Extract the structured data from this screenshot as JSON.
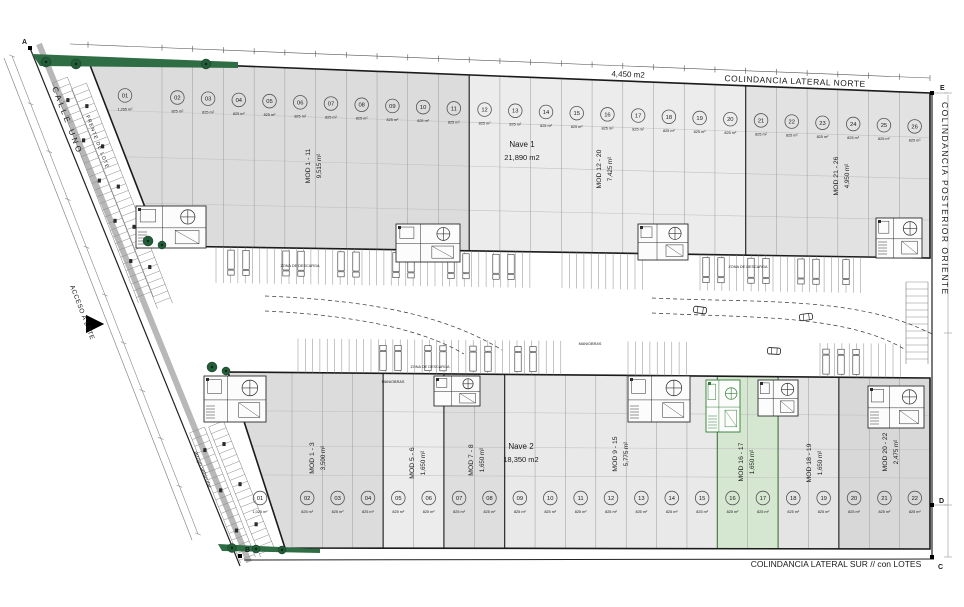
{
  "plan": {
    "streets": {
      "calle_uno": "CALLE UNO",
      "frente_de_lote": "FRENTE DE LOTE",
      "acceso_a_lote": "ACCESO A LOTE",
      "arroyo_vehicular": "arroyo vehicular"
    },
    "boundaries": {
      "north": "COLINDANCIA LATERAL NORTE",
      "east": "COLINDANCIA POSTERIOR ORIENTE",
      "south": "COLINDANCIA LATERAL SUR // con LOTES"
    },
    "corner_points": [
      "A",
      "B",
      "C",
      "D",
      "E"
    ],
    "top_area_label": "4,450 m2",
    "zone_labels": {
      "descarga": "ZONA DE DESCARGA",
      "maniobras": "MANIOBRAS"
    },
    "colors": {
      "highlight_green": "#d5e7d1",
      "tree_green": "#2f6e45",
      "module_gray_dark": "#dcdcdc",
      "module_gray_light": "#ececec"
    },
    "nave1": {
      "name": "Nave 1",
      "area": "21,890 m2",
      "groups": [
        {
          "label": "MOD 1 - 11",
          "area": "9,515 m²"
        },
        {
          "label": "MOD 12 - 20",
          "area": "7,425 m²"
        },
        {
          "label": "MOD 21 - 26",
          "area": "4,950 m²"
        }
      ],
      "modules": [
        {
          "num": "01",
          "area": "1,265 m²"
        },
        {
          "num": "02",
          "area": "825 m²"
        },
        {
          "num": "03",
          "area": "825 m²"
        },
        {
          "num": "04",
          "area": "825 m²"
        },
        {
          "num": "05",
          "area": "825 m²"
        },
        {
          "num": "06",
          "area": "825 m²"
        },
        {
          "num": "07",
          "area": "825 m²"
        },
        {
          "num": "08",
          "area": "825 m²"
        },
        {
          "num": "09",
          "area": "825 m²"
        },
        {
          "num": "10",
          "area": "825 m²"
        },
        {
          "num": "11",
          "area": "825 m²"
        },
        {
          "num": "12",
          "area": "825 m²"
        },
        {
          "num": "13",
          "area": "825 m²"
        },
        {
          "num": "14",
          "area": "825 m²"
        },
        {
          "num": "15",
          "area": "825 m²"
        },
        {
          "num": "16",
          "area": "825 m²"
        },
        {
          "num": "17",
          "area": "825 m²"
        },
        {
          "num": "18",
          "area": "825 m²"
        },
        {
          "num": "19",
          "area": "825 m²"
        },
        {
          "num": "20",
          "area": "825 m²"
        },
        {
          "num": "21",
          "area": "825 m²"
        },
        {
          "num": "22",
          "area": "825 m²"
        },
        {
          "num": "23",
          "area": "825 m²"
        },
        {
          "num": "24",
          "area": "825 m²"
        },
        {
          "num": "25",
          "area": "825 m²"
        },
        {
          "num": "26",
          "area": "825 m²"
        }
      ]
    },
    "nave2": {
      "name": "Nave 2",
      "area": "18,350 m2",
      "groups": [
        {
          "label": "MOD 1 - 3",
          "area": "3,500 m²"
        },
        {
          "label": "MOD 5 - 6",
          "area": "1,650 m²"
        },
        {
          "label": "MOD 7 - 8",
          "area": "1,650 m²"
        },
        {
          "label": "MOD 9 - 15",
          "area": "5,775 m²"
        },
        {
          "label": "MOD 16 - 17",
          "area": "1,650 m²"
        },
        {
          "label": "MOD 18 - 19",
          "area": "1,650 m²"
        },
        {
          "label": "MOD 20 - 22",
          "area": "2,475 m²"
        }
      ],
      "modules": [
        {
          "num": "01",
          "area": "1,025 m²"
        },
        {
          "num": "02",
          "area": "825 m²"
        },
        {
          "num": "03",
          "area": "825 m²"
        },
        {
          "num": "04",
          "area": "825 m²"
        },
        {
          "num": "05",
          "area": "825 m²"
        },
        {
          "num": "06",
          "area": "825 m²"
        },
        {
          "num": "07",
          "area": "825 m²"
        },
        {
          "num": "08",
          "area": "825 m²"
        },
        {
          "num": "09",
          "area": "825 m²"
        },
        {
          "num": "10",
          "area": "825 m²"
        },
        {
          "num": "11",
          "area": "825 m²"
        },
        {
          "num": "12",
          "area": "825 m²"
        },
        {
          "num": "13",
          "area": "825 m²"
        },
        {
          "num": "14",
          "area": "825 m²"
        },
        {
          "num": "15",
          "area": "825 m²"
        },
        {
          "num": "16",
          "area": "825 m²"
        },
        {
          "num": "17",
          "area": "825 m²"
        },
        {
          "num": "18",
          "area": "825 m²"
        },
        {
          "num": "19",
          "area": "825 m²"
        },
        {
          "num": "20",
          "area": "825 m²"
        },
        {
          "num": "21",
          "area": "825 m²"
        },
        {
          "num": "22",
          "area": "825 m²"
        }
      ]
    }
  }
}
